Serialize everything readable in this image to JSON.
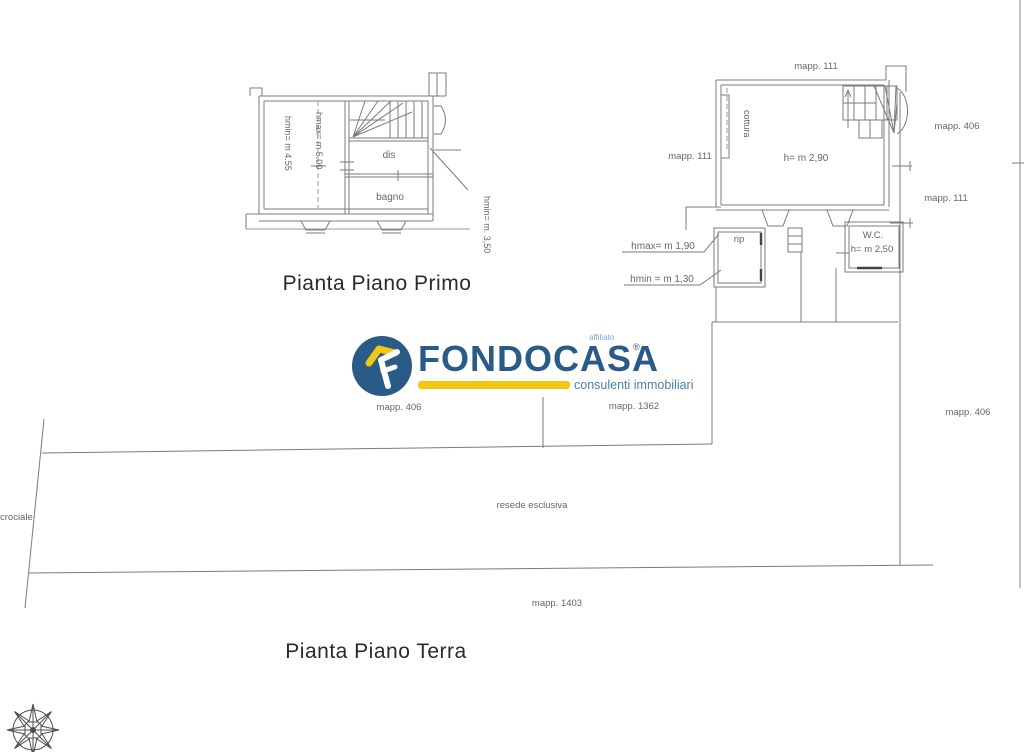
{
  "logo": {
    "brand": "FONDOCASA",
    "registered": "®",
    "affiliate_label": "affiliato",
    "tagline": "consulenti immobiliari",
    "colors": {
      "blue": "#2a5a88",
      "yellow": "#f2c713",
      "light_blue": "#4d7fae"
    }
  },
  "first_floor": {
    "title": "Pianta Piano Primo",
    "room_dis": "dis",
    "room_bagno": "bagno",
    "hmin_left": "hmin= m 4.55",
    "hmax_left": "hmax= m 5.00",
    "hmin_right": "hmin= m. 3,50"
  },
  "ground_floor": {
    "title": "Pianta Piano Terra",
    "room_cottura": "cottura",
    "room_rip": "rip",
    "room_wc": "W.C.",
    "wc_height": "h= m 2,50",
    "main_height": "h= m 2,90",
    "hmax_label": "hmax= m 1,90",
    "hmin_label": "hmin = m 1,30"
  },
  "map_labels": {
    "top": "mapp. 111",
    "right_upper": "mapp. 406",
    "right_mid": "mapp. 111",
    "left": "mapp. 111",
    "below_logo_left": "mapp. 406",
    "below_logo_right": "mapp. 1362",
    "bottom_right": "mapp. 406",
    "bottom": "mapp. 1403"
  },
  "site": {
    "area_label": "resede esclusiva",
    "street_label": "crociale"
  }
}
